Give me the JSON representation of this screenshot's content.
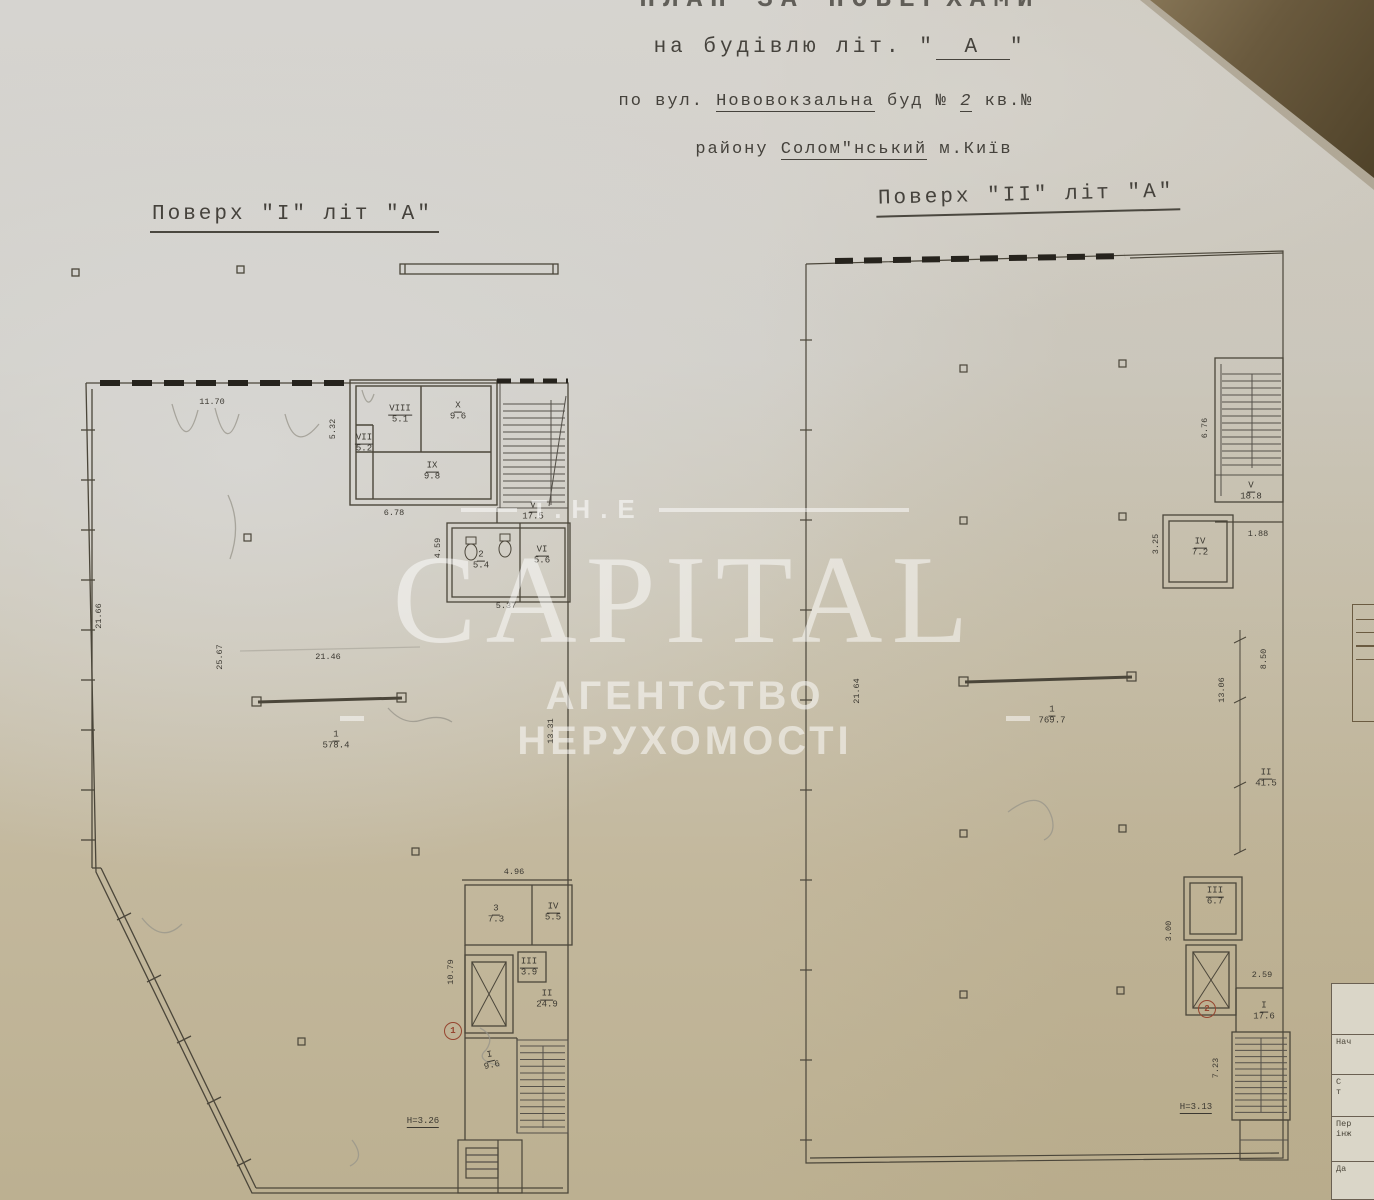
{
  "header": {
    "title": "ПЛАН ЗА ПОВЕРХАМИ",
    "building_prefix": "на будівлю літ. \"",
    "building_letter": "А",
    "building_suffix": "\"",
    "street_prefix": "по вул.",
    "street_name": "Нововокзальна",
    "street_mid": "буд №",
    "building_no": "2",
    "street_suffix": "кв.№",
    "district_prefix": "району",
    "district_name": "Солом\"нський",
    "district_suffix": "м.Київ"
  },
  "plan1": {
    "title": "Поверх \"I\" літ \"А\"",
    "rooms": [
      {
        "id": "VIII",
        "area": "5.1"
      },
      {
        "id": "X",
        "area": "9.6"
      },
      {
        "id": "VII",
        "area": "5.2"
      },
      {
        "id": "IX",
        "area": "9.8"
      },
      {
        "id": "V",
        "area": "17.5"
      },
      {
        "id": "2",
        "area": "5.4"
      },
      {
        "id": "VI",
        "area": "5.6"
      },
      {
        "id": "1",
        "area": "578.4"
      },
      {
        "id": "3",
        "area": "7.3"
      },
      {
        "id": "IV",
        "area": "5.5"
      },
      {
        "id": "III",
        "area": "3.9"
      },
      {
        "id": "II",
        "area": "24.9"
      },
      {
        "id": "I",
        "area": "9.6"
      }
    ],
    "dims": {
      "top": "11.70",
      "block_left": "5.32",
      "block_bottom": "6.78",
      "wc_left": "4.59",
      "wc_bottom": "5.37",
      "left": "21.66",
      "hall": "25.67",
      "beam": "21.46",
      "right": "13.31",
      "south_top": "4.96",
      "south_left": "10.79"
    },
    "height_note": "H=3.26",
    "marker": "1"
  },
  "plan2": {
    "title": "Поверх \"II\" літ \"А\"",
    "rooms": [
      {
        "id": "V",
        "area": "18.8"
      },
      {
        "id": "IV",
        "area": "7.2"
      },
      {
        "id": "1",
        "area": "769.7"
      },
      {
        "id": "III",
        "area": "6.7"
      },
      {
        "id": "II",
        "area": "41.5"
      },
      {
        "id": "I",
        "area": "17.6"
      }
    ],
    "dims": {
      "stair_top": "6.76",
      "room4_left": "3.25",
      "room5_right": "1.88",
      "right_upper": "8.50",
      "right_mid": "13.06",
      "left": "21.64",
      "room3_left": "3.00",
      "room1_top": "2.59",
      "stair_bottom_left": "7.23"
    },
    "height_note": "H=3.13",
    "marker": "2"
  },
  "watermark": {
    "brand_top": "T.H.E",
    "brand": "CAPITAL",
    "tagline": "АГЕНТСТВО НЕРУХОМОСТІ"
  },
  "title_block": {
    "rows": [
      "",
      "Нач",
      "С\nт",
      "Пер\nінж",
      "Да"
    ]
  }
}
